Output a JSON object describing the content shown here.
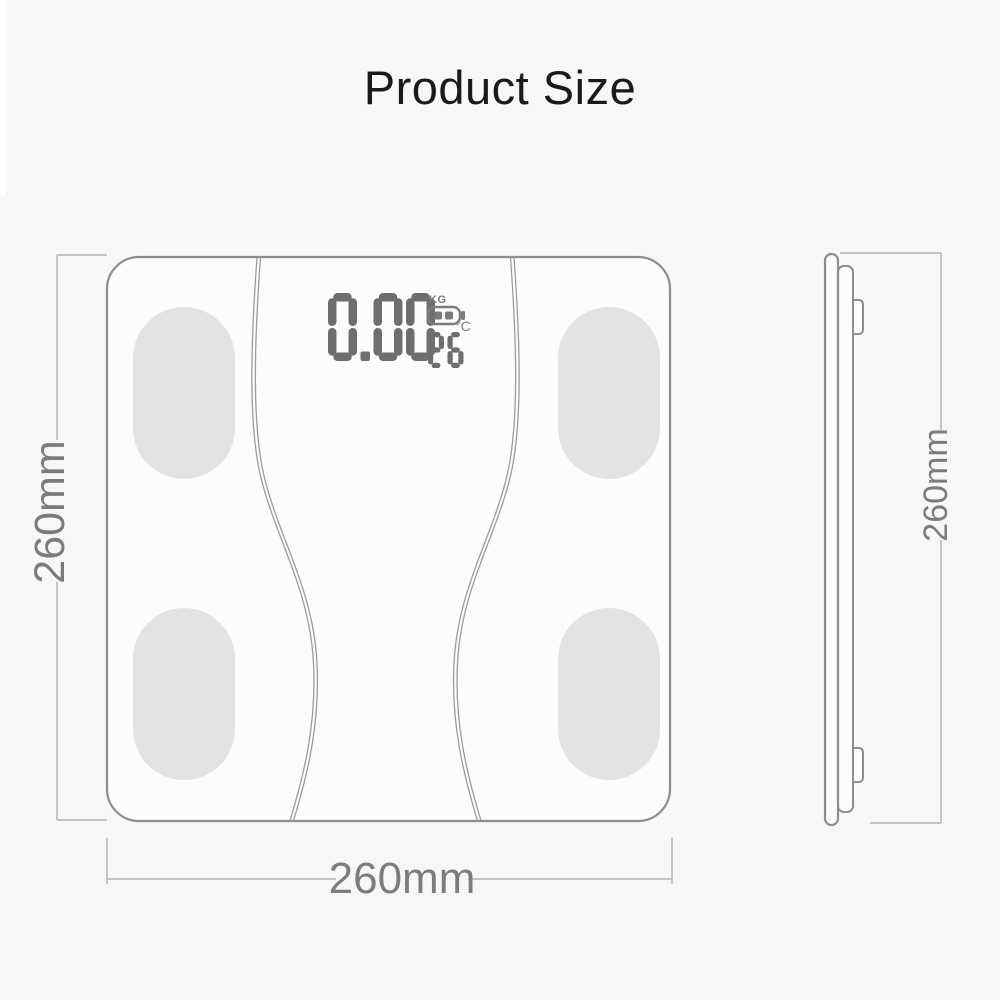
{
  "title": "Product Size",
  "front_view": {
    "width_label": "260mm",
    "height_label": "260mm",
    "display": {
      "weight_value": "0.00",
      "weight_unit": "KG",
      "temperature_value": "26",
      "temperature_unit": "°C",
      "battery_icon": "battery-two-bars-icon"
    },
    "electrode_pads_count": 4
  },
  "side_view": {
    "height_label": "260mm"
  },
  "colors": {
    "background": "#f7f7f7",
    "strip": "#ffffff",
    "title_text": "#1a1a1a",
    "outline": "#8d8d8d",
    "face": "#fcfcfc",
    "pad": "#e3e3e3",
    "curve": "#9c9c9c",
    "dim_line": "#b4b4b4",
    "dim_text": "#7c7c7c",
    "segment": "#6e6e6e",
    "display_gray": "#7b7b7b"
  }
}
